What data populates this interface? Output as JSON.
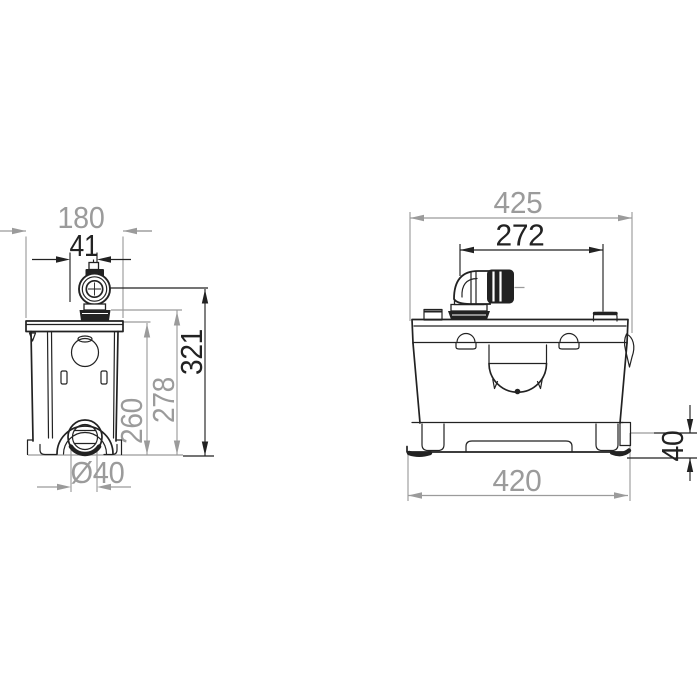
{
  "drawing": {
    "colors": {
      "object_line": "#222222",
      "dim_black": "#222222",
      "dim_gray": "#9b9b9b",
      "background": "#ffffff"
    },
    "side_view": {
      "dims": {
        "width": "180",
        "outlet_offset": "41",
        "height_total": "321",
        "height_discharge_base": "278",
        "height_tank": "260",
        "outlet_diameter": "Ø40"
      }
    },
    "front_view": {
      "dims": {
        "width_overall": "425",
        "port_spacing": "272",
        "base_width": "420",
        "skirt_height": "40"
      }
    }
  }
}
